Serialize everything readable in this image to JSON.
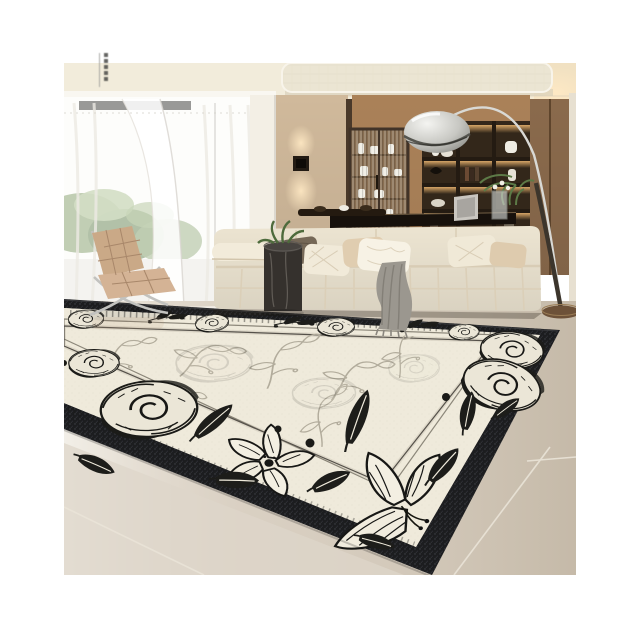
{
  "image": {
    "alt": "Product photo of a cream rug with a black border and black hand-sketched floral toile pattern, staged in a modern living room with a cream modular sofa, tan Barcelona chair, sheer-curtained window, backlit wood shelving, dark floating desk and an arc floor lamp on beige tile flooring"
  },
  "colors": {
    "page_bg": "#ffffff",
    "ceiling": "#f2ecdb",
    "ceiling_panel": "#ebe5d3",
    "ceiling_warm": "#f1e1c2",
    "window": "#fafaf6",
    "curtain": "#ffffff",
    "foliage": "#7d9a63",
    "pillar": "#f3efe5",
    "wall_beige": "#d0b99b",
    "cabinet_wood": "#aa8158",
    "shelf_interior": "#33271a",
    "right_cabinet": "#8a6a4c",
    "right_wall": "#e7e0d1",
    "desk": "#17110c",
    "chair_leather": "#caa987",
    "sofa": "#ece4d1",
    "throw": "#9b978f",
    "side_table": "#35312d",
    "floor": "#d7cec1",
    "rug_black": "#1c1d1f",
    "rug_cream": "#efeadb",
    "rug_ink": "#171715",
    "rug_faint": "#b2ac9c",
    "lamp_base": "#6d5138",
    "chrome": "#cfcfc9"
  }
}
